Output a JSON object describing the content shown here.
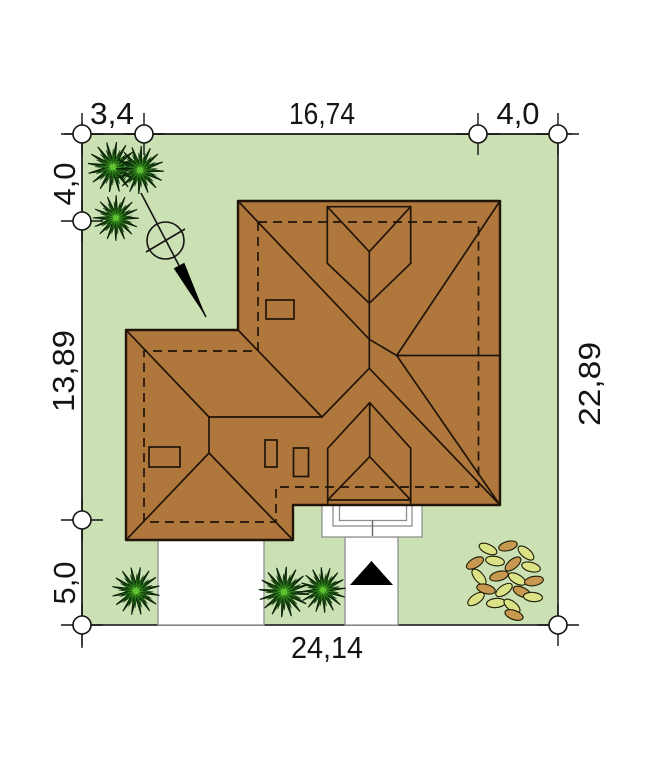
{
  "page": {
    "type": "architectural site plan drawing",
    "background": "#ffffff"
  },
  "dimensions": {
    "top_left": "3,4",
    "top_middle": "16,74",
    "top_right": "4,0",
    "left_top": "4,0",
    "left_middle": "13,89",
    "left_bottom": "5,0",
    "right_side": "22,89",
    "bottom_total": "24,14"
  },
  "icons": {
    "north_arrow": "north-arrow-compass",
    "entrance_marker": "entrance-triangle",
    "shrub": "spiky-shrub",
    "big_bush": "leafy-bush",
    "survey_marker": "circle-cross-marker"
  },
  "colors": {
    "plot_green": "#cbe0b3",
    "roof_brown": "#b0773c",
    "line_black": "#1c1c1c",
    "roof_line": "#201508",
    "shrub_dark": "#1e5c14",
    "shrub_mid": "#2f8a1d",
    "shrub_bright": "#5ec32f",
    "leaf_yellow_green": "#dce387",
    "leaf_tan": "#c69850",
    "paving_white": "#ffffff",
    "paving_border_gray": "#8f8f8f",
    "marker_black": "#141414"
  }
}
